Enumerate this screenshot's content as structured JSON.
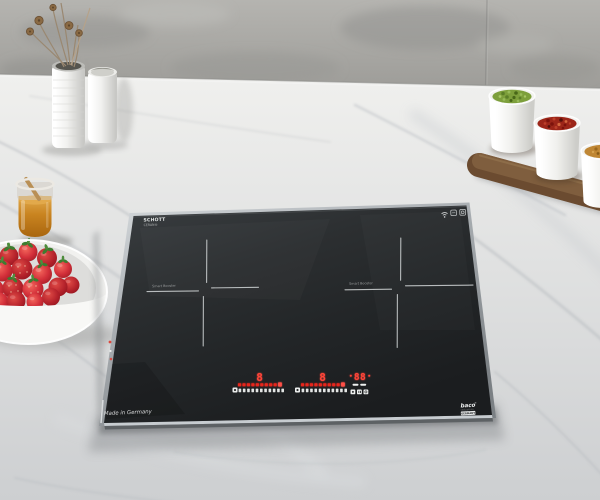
{
  "scene_title": "Two-zone induction hob on a marble kitchen countertop",
  "hob": {
    "surface_print": {
      "glass_brand_line1": "SCHOTT",
      "glass_brand_line2": "CERAN®"
    },
    "zone_left_label": "Smart Booster",
    "zone_right_label": "Smart Booster",
    "made_in_text": "Made in Germany",
    "logo": {
      "name": "baco",
      "reg": "®",
      "tagline": "induction",
      "badge": "GERMANY"
    },
    "display": {
      "zone1": "8",
      "zone2": "8",
      "timer": "88"
    },
    "controls": {
      "slider_segments": 10,
      "tick_count": 11
    },
    "colors": {
      "glass": "#26282a",
      "led_red": "#ff4438",
      "rim": "#9aa0a4",
      "print_white": "#e8eaea"
    }
  },
  "props": {
    "wall": "grey concrete wall",
    "counter": "white-grey marble countertop",
    "vases": {
      "count": 2,
      "color": "#f2f2f0",
      "contents": "dried flowers"
    },
    "honey_jar": {
      "content_color": "#c98420"
    },
    "strawberry_bowl": {
      "bowl_color": "#f8f8f6",
      "berry_color": "#c62630",
      "leaf_color": "#3f7c31"
    },
    "spice_cups": {
      "contents": [
        "#7d9f3b",
        "#9c2619",
        "#bf8634"
      ],
      "board_color": "#7a5a3c"
    }
  },
  "icons": [
    "wifi-icon",
    "cert-badge-icon",
    "cert-badge-icon",
    "power-icon",
    "lock-icon",
    "pause-icon"
  ]
}
